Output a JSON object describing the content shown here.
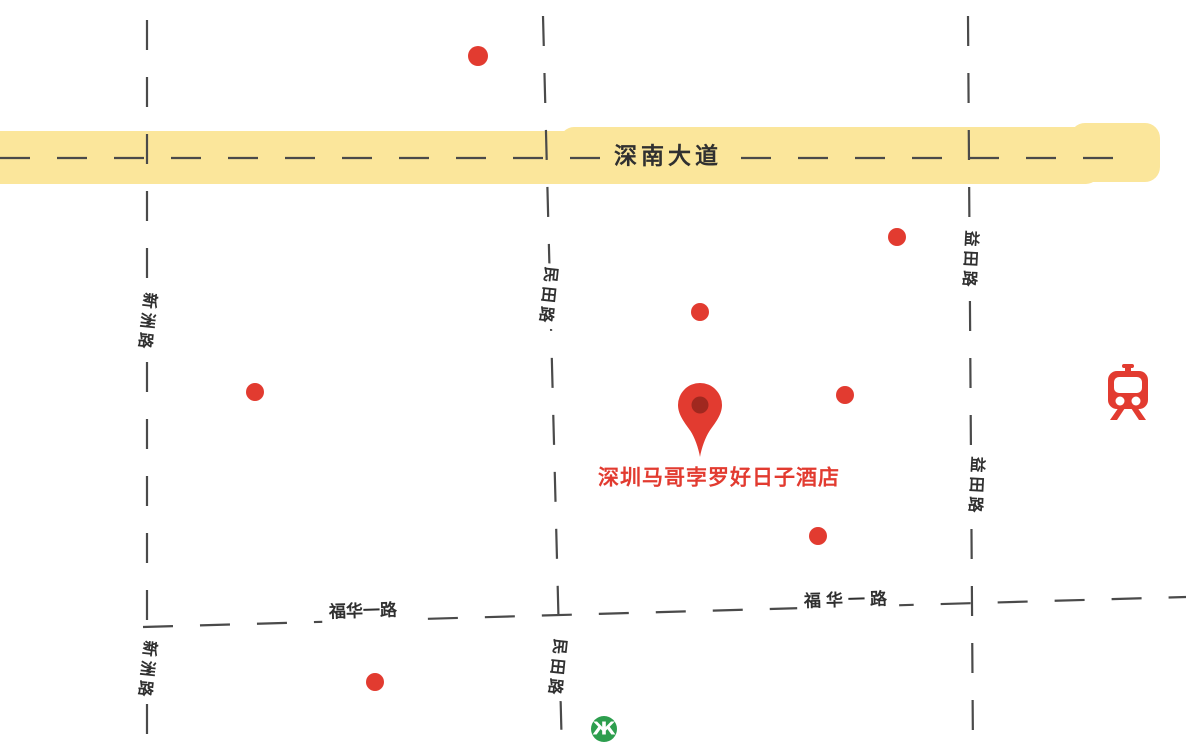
{
  "map": {
    "roads": {
      "shennan_avenue": {
        "label": "深南大道",
        "style": "major-avenue-yellow-highlight"
      },
      "xinzhou_road": {
        "label": "新洲路",
        "style": "dashed-vertical"
      },
      "mintian_road": {
        "label": "民田路",
        "style": "dashed-vertical"
      },
      "yitian_road": {
        "label": "益田路",
        "style": "dashed-vertical"
      },
      "fuhua_1st_road": {
        "label": "福华一路",
        "style": "dashed-horizontal"
      }
    },
    "hotel": {
      "label": "深圳马哥孛罗好日子酒店"
    },
    "markers": {
      "poi_dots": [
        {
          "x": 478,
          "y": 56,
          "r": 10
        },
        {
          "x": 897,
          "y": 237,
          "r": 9
        },
        {
          "x": 700,
          "y": 312,
          "r": 9
        },
        {
          "x": 255,
          "y": 392,
          "r": 9
        },
        {
          "x": 845,
          "y": 395,
          "r": 9
        },
        {
          "x": 818,
          "y": 536,
          "r": 9
        },
        {
          "x": 375,
          "y": 682,
          "r": 9
        }
      ]
    },
    "stations": {
      "train": {
        "icon": "train-station-icon"
      },
      "metro": {
        "icon": "shenzhen-metro-icon",
        "glyph": "Ж"
      }
    },
    "colors": {
      "marker_red": "#E23B30",
      "pin_inner": "#A0281F",
      "metro_green": "#2D9E4E",
      "road_highlight_yellow": "#FBE69B",
      "road_dash_gray": "#4A4A4A",
      "label_dark": "#303030",
      "background": "#FFFFFF"
    }
  }
}
